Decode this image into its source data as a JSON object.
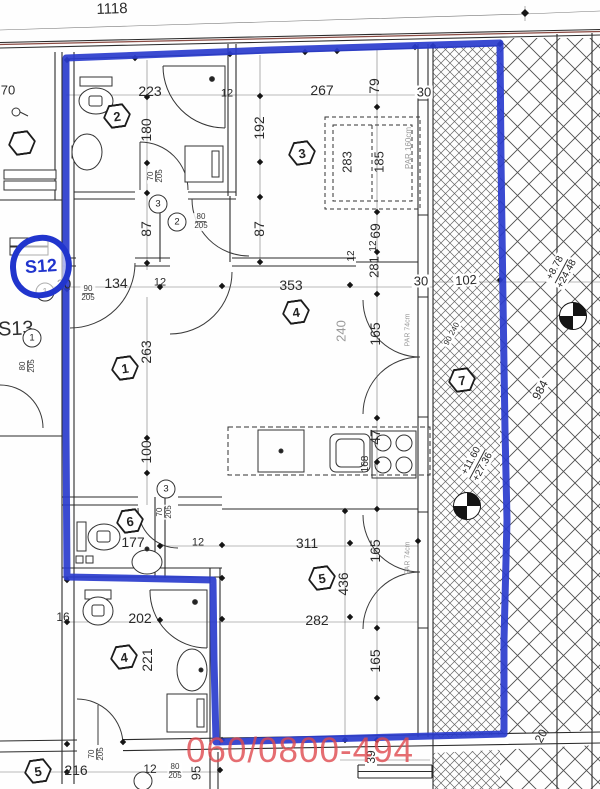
{
  "plan": {
    "unit_badge": "S12",
    "neighbor_unit": "S13",
    "watermark": "060/0800-494",
    "colors": {
      "boundary_blue": "#2a3ccd",
      "watermark_red": "#df484d",
      "line_dark": "#2b2b2b",
      "muted_gray": "#9a9a9a",
      "wall_red_line": "#8a4a42"
    },
    "dim_labels": [
      {
        "t": "1118",
        "x": 112,
        "y": 9,
        "r": -2,
        "s": 15
      },
      {
        "t": "70",
        "x": 8,
        "y": 90,
        "r": 0,
        "s": 13
      },
      {
        "t": "223",
        "x": 150,
        "y": 91,
        "r": 0,
        "s": 14
      },
      {
        "t": "12",
        "x": 227,
        "y": 94,
        "r": 0,
        "s": 11
      },
      {
        "t": "267",
        "x": 322,
        "y": 90,
        "r": 0,
        "s": 14
      },
      {
        "t": "79",
        "x": 374,
        "y": 86,
        "r": -90,
        "s": 14
      },
      {
        "t": "30",
        "x": 424,
        "y": 92,
        "r": 0,
        "s": 13,
        "bg": 1
      },
      {
        "t": "180",
        "x": 146,
        "y": 130,
        "r": -90,
        "s": 14
      },
      {
        "t": "192",
        "x": 259,
        "y": 128,
        "r": -90,
        "s": 14
      },
      {
        "t": "283",
        "x": 347,
        "y": 162,
        "r": -90,
        "s": 13
      },
      {
        "t": "185",
        "x": 379,
        "y": 162,
        "r": -90,
        "s": 13
      },
      {
        "t": "PAR 160cm",
        "x": 409,
        "y": 148,
        "r": -90,
        "s": 8,
        "c": "gray"
      },
      {
        "t": "87",
        "x": 146,
        "y": 229,
        "r": -90,
        "s": 14
      },
      {
        "t": "87",
        "x": 259,
        "y": 229,
        "r": -90,
        "s": 14
      },
      {
        "t": "69",
        "x": 375,
        "y": 231,
        "r": -90,
        "s": 14
      },
      {
        "t": "12",
        "x": 352,
        "y": 256,
        "r": -90,
        "s": 10
      },
      {
        "t": "12",
        "x": 374,
        "y": 246,
        "r": -90,
        "s": 10
      },
      {
        "t": "281",
        "x": 374,
        "y": 267,
        "r": -90,
        "s": 13
      },
      {
        "t": "20",
        "x": 64,
        "y": 284,
        "r": 0,
        "s": 13
      },
      {
        "t": "134",
        "x": 116,
        "y": 283,
        "r": 0,
        "s": 14
      },
      {
        "t": "12",
        "x": 160,
        "y": 283,
        "r": 0,
        "s": 11
      },
      {
        "t": "353",
        "x": 291,
        "y": 285,
        "r": 0,
        "s": 14
      },
      {
        "t": "30",
        "x": 421,
        "y": 281,
        "r": 0,
        "s": 13,
        "bg": 1
      },
      {
        "t": "102",
        "x": 466,
        "y": 280,
        "r": -4,
        "s": 13,
        "bg": 1
      },
      {
        "t": "263",
        "x": 146,
        "y": 352,
        "r": -90,
        "s": 14
      },
      {
        "t": "240",
        "x": 341,
        "y": 331,
        "r": -90,
        "s": 13,
        "c": "gray"
      },
      {
        "t": "165",
        "x": 375,
        "y": 334,
        "r": -90,
        "s": 14
      },
      {
        "t": "PAR 74cm",
        "x": 408,
        "y": 330,
        "r": -90,
        "s": 7,
        "c": "gray"
      },
      {
        "t": "90 240",
        "x": 452,
        "y": 334,
        "r": -62,
        "s": 8,
        "bg": 1
      },
      {
        "t": "100",
        "x": 146,
        "y": 452,
        "r": -90,
        "s": 14
      },
      {
        "t": "47",
        "x": 375,
        "y": 437,
        "r": -90,
        "s": 14
      },
      {
        "t": "168",
        "x": 366,
        "y": 464,
        "r": -90,
        "s": 10
      },
      {
        "t": "177",
        "x": 133,
        "y": 542,
        "r": 0,
        "s": 14
      },
      {
        "t": "12",
        "x": 198,
        "y": 543,
        "r": 0,
        "s": 11
      },
      {
        "t": "311",
        "x": 307,
        "y": 543,
        "r": 0,
        "s": 14
      },
      {
        "t": "165",
        "x": 375,
        "y": 551,
        "r": -90,
        "s": 14
      },
      {
        "t": "PAR 74cm",
        "x": 408,
        "y": 558,
        "r": -90,
        "s": 7,
        "c": "gray"
      },
      {
        "t": "436",
        "x": 343,
        "y": 584,
        "r": -90,
        "s": 14
      },
      {
        "t": "16",
        "x": 63,
        "y": 617,
        "r": 0,
        "s": 12
      },
      {
        "t": "202",
        "x": 140,
        "y": 618,
        "r": 0,
        "s": 14
      },
      {
        "t": "282",
        "x": 317,
        "y": 620,
        "r": 0,
        "s": 14
      },
      {
        "t": "165",
        "x": 375,
        "y": 661,
        "r": -90,
        "s": 14
      },
      {
        "t": "221",
        "x": 147,
        "y": 660,
        "r": -90,
        "s": 14
      },
      {
        "t": "216",
        "x": 76,
        "y": 770,
        "r": 0,
        "s": 14
      },
      {
        "t": "12",
        "x": 150,
        "y": 769,
        "r": 0,
        "s": 12
      },
      {
        "t": "95",
        "x": 196,
        "y": 773,
        "r": -90,
        "s": 13
      },
      {
        "t": "39",
        "x": 371,
        "y": 757,
        "r": -90,
        "s": 12,
        "bg": 1
      },
      {
        "t": "984",
        "x": 540,
        "y": 390,
        "r": -62,
        "s": 12,
        "bg": 1
      },
      {
        "t": "20",
        "x": 541,
        "y": 736,
        "r": -62,
        "s": 12
      }
    ],
    "door_labels": [
      {
        "w": "70",
        "h": "205",
        "x": 156,
        "y": 176,
        "r": -90
      },
      {
        "w": "80",
        "h": "205",
        "x": 201,
        "y": 222,
        "r": 0
      },
      {
        "w": "90",
        "h": "205",
        "x": 88,
        "y": 294,
        "r": 0
      },
      {
        "w": "80",
        "h": "205",
        "x": 28,
        "y": 366,
        "r": -90
      },
      {
        "w": "70",
        "h": "205",
        "x": 165,
        "y": 512,
        "r": -90
      },
      {
        "w": "70",
        "h": "205",
        "x": 97,
        "y": 754,
        "r": -90
      },
      {
        "w": "80",
        "h": "205",
        "x": 175,
        "y": 772,
        "r": 0
      }
    ],
    "room_markers": [
      {
        "n": "2",
        "x": 117,
        "y": 116
      },
      {
        "n": "3",
        "x": 302,
        "y": 153
      },
      {
        "n": "4",
        "x": 296,
        "y": 312
      },
      {
        "n": "1",
        "x": 125,
        "y": 368
      },
      {
        "n": "7",
        "x": 462,
        "y": 380
      },
      {
        "n": "6",
        "x": 130,
        "y": 521
      },
      {
        "n": "5",
        "x": 322,
        "y": 578
      },
      {
        "n": "4",
        "x": 124,
        "y": 657
      },
      {
        "n": "5",
        "x": 38,
        "y": 771
      },
      {
        "n": "",
        "x": 22,
        "y": 143
      }
    ],
    "position_markers": [
      {
        "n": "3",
        "x": 158,
        "y": 204
      },
      {
        "n": "2",
        "x": 177,
        "y": 222
      },
      {
        "n": "1",
        "x": 45,
        "y": 292
      },
      {
        "n": "1",
        "x": 32,
        "y": 338
      },
      {
        "n": "3",
        "x": 166,
        "y": 489
      },
      {
        "n": "",
        "x": 143,
        "y": 781
      }
    ],
    "elevation_markers": [
      {
        "x": 573,
        "y": 316,
        "values": [
          "+8.78",
          "+24.48"
        ],
        "lx": 561,
        "ly": 271,
        "r": -62
      },
      {
        "x": 467,
        "y": 506,
        "values": [
          "+11.60",
          "+27.36"
        ],
        "lx": 477,
        "ly": 464,
        "r": -62
      }
    ]
  }
}
